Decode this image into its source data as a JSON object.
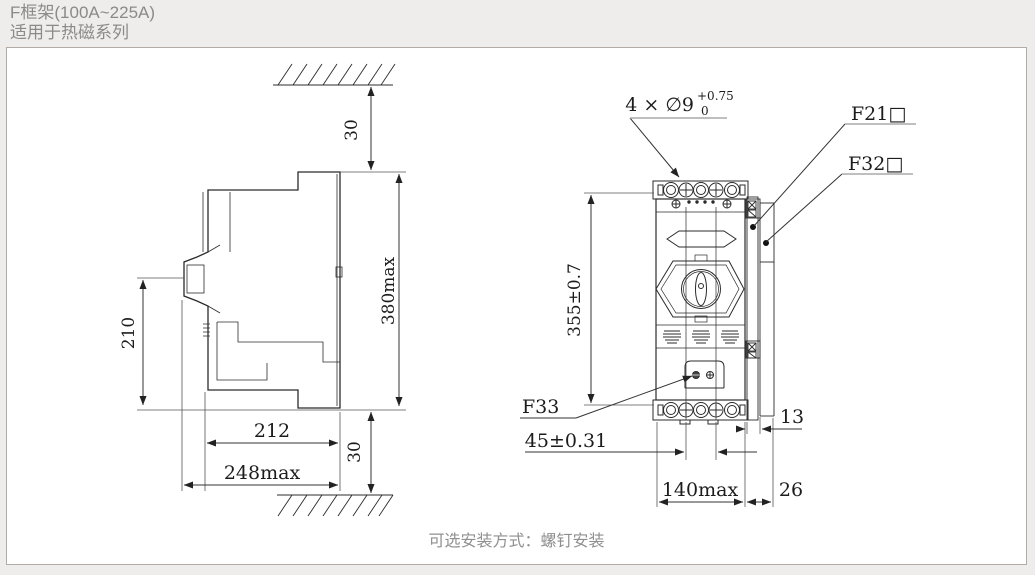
{
  "header": {
    "title": "F框架(100A~225A)",
    "subtitle": "适用于热磁系列"
  },
  "caption": "可选安装方式：螺钉安装",
  "side_view": {
    "dims": {
      "top_gap": "30",
      "bottom_gap": "30",
      "height_max": "380max",
      "front_height": "210",
      "depth": "212",
      "depth_max": "248max"
    }
  },
  "front_view": {
    "dims": {
      "height": "355±0.7",
      "hole_spacing": "45±0.31",
      "width_max": "140max",
      "offset_13": "13",
      "offset_26": "26"
    },
    "labels": {
      "holes_prefix": "4 × ∅9",
      "holes_tol_upper": "+0.75",
      "holes_tol_lower": "0",
      "f21": "F21□",
      "f32": "F32□",
      "f33": "F33"
    }
  },
  "colors": {
    "line": "#2b2b2b",
    "dim_line": "#444444",
    "underline_gray": "#aaaaaa",
    "header_text": "#8a8a88",
    "caption_text": "#8f8f8f",
    "page_bg": "#eeedeb",
    "box_bg": "#ffffff",
    "box_border": "#b3aca6"
  }
}
